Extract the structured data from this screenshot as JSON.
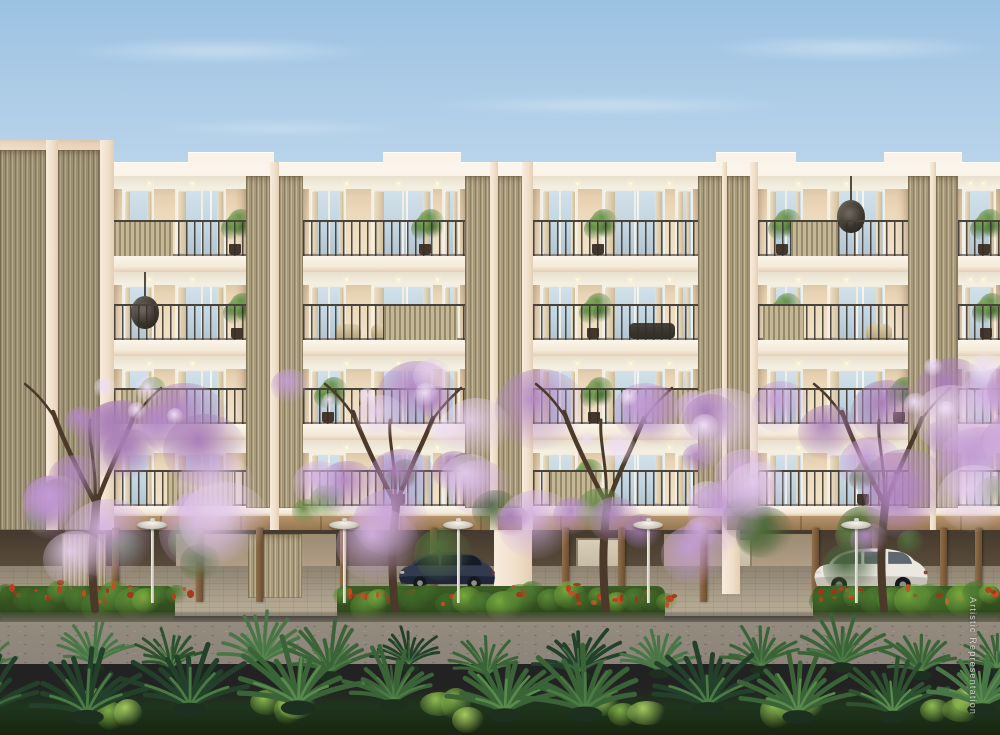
{
  "watermark": {
    "text": "Artistic Representation"
  },
  "scene": {
    "description": "Architectural rendering of a 4-storey cream apartment building with balconies, louver screens, stilt parking with two cars, purple flowering trees, garden lamps, red-flower hedges, a road and foreground palms",
    "colors": {
      "sky_top": "#9cc2e2",
      "sky_mid": "#c6dcee",
      "sky_horizon": "#edf2f2",
      "facade": "#f6e8d7",
      "facade_wing": "#f0deca",
      "roof_band": "#f9f3e9",
      "interior": "#ecd9bb",
      "ceiling": "#f4efe3",
      "glass": "#c8d9e4",
      "curtain": "#e6dac1",
      "railing": "#413c34",
      "louver_light": "#c2b594",
      "louver_dark": "#8c7f63",
      "wood_beam": "#b6946c",
      "wood_post": "#7c5c3c",
      "stilt_dark": "#443a2d",
      "stilt_mid": "#6e5f4b",
      "backwall": "#c0ae92",
      "paver_lit": "#b3a892",
      "paver_shade": "#8d8270",
      "curb": "#6e675c",
      "road": "#8d8479",
      "hedge_green": "#4c7a31",
      "hedge_light": "#76a93e",
      "flower_red": "#bb3f1e",
      "blossoms": [
        "#d5b3e2",
        "#c39cd4",
        "#b287c4",
        "#e3cdeb",
        "#a97fb8"
      ],
      "leaf_green": "#647f41",
      "trunk": "#4b392a",
      "palm_greens": [
        "#22402a",
        "#2e512f",
        "#3a6438",
        "#497647"
      ],
      "car_dark": "#323a4e",
      "car_white": "#ebe8e2",
      "lamp": "#eae7dd"
    },
    "building": {
      "roof_y": 162,
      "wing_top": 140,
      "wing_w": 114,
      "base_y": 530,
      "parapet_steps": [
        [
          188,
          86
        ],
        [
          383,
          78
        ],
        [
          716,
          80
        ],
        [
          884,
          78
        ]
      ],
      "floor_openings": [
        [
          176,
          256
        ],
        [
          272,
          340
        ],
        [
          356,
          424
        ],
        [
          440,
          506
        ]
      ],
      "rail_h": 36,
      "modules": [
        [
          "louver",
          0,
          46,
          1
        ],
        [
          "pier",
          46,
          12,
          1
        ],
        [
          "louver",
          58,
          42,
          1
        ],
        [
          "pier",
          100,
          14,
          1
        ],
        [
          "bay",
          114,
          132,
          0
        ],
        [
          "louver",
          246,
          24,
          0
        ],
        [
          "pier",
          270,
          9,
          0
        ],
        [
          "louver",
          279,
          24,
          0
        ],
        [
          "bay",
          303,
          162,
          0
        ],
        [
          "louver",
          465,
          25,
          0
        ],
        [
          "pier",
          490,
          8,
          0
        ],
        [
          "louver",
          498,
          24,
          0
        ],
        [
          "pier",
          522,
          11,
          0
        ],
        [
          "bay",
          533,
          165,
          0
        ],
        [
          "louver",
          698,
          24,
          0
        ],
        [
          "pier",
          722,
          5,
          0
        ],
        [
          "louver",
          727,
          23,
          0
        ],
        [
          "pier",
          750,
          8,
          0
        ],
        [
          "bay",
          758,
          150,
          0
        ],
        [
          "louver",
          908,
          22,
          0
        ],
        [
          "pier",
          930,
          6,
          0
        ],
        [
          "louver",
          936,
          22,
          0
        ],
        [
          "bay",
          958,
          42,
          0
        ]
      ],
      "slat_sections": [
        [
          0,
          0,
          0.0,
          0.45
        ],
        [
          0,
          3,
          0.22,
          0.53
        ],
        [
          1,
          1,
          0.5,
          0.95
        ],
        [
          1,
          3,
          0.03,
          0.3
        ],
        [
          2,
          0,
          0.05,
          0.5
        ],
        [
          2,
          2,
          0.72,
          1
        ],
        [
          3,
          2,
          0.1,
          0.4
        ],
        [
          3,
          0,
          0.4,
          0.9
        ]
      ],
      "decorations": [
        [
          0,
          0,
          "plant",
          0.8
        ],
        [
          0,
          1,
          "plant",
          0.66
        ],
        [
          0,
          2,
          "plant",
          0.3
        ],
        [
          0,
          3,
          "plant",
          0.06
        ],
        [
          0,
          3,
          "egg",
          0.52
        ],
        [
          0,
          4,
          "plant",
          0.25
        ],
        [
          1,
          0,
          "egg",
          0.12
        ],
        [
          1,
          0,
          "plant",
          0.82
        ],
        [
          1,
          1,
          "seat",
          0.2
        ],
        [
          1,
          1,
          "seat",
          0.42
        ],
        [
          1,
          2,
          "plant",
          0.27
        ],
        [
          1,
          2,
          "sofa",
          0.58
        ],
        [
          1,
          3,
          "seat",
          0.72
        ],
        [
          1,
          3,
          "plant",
          0.06
        ],
        [
          1,
          4,
          "plant",
          0.3
        ],
        [
          2,
          0,
          "plant",
          0.14
        ],
        [
          2,
          1,
          "plant",
          0.06
        ],
        [
          2,
          2,
          "plant",
          0.28
        ],
        [
          2,
          3,
          "plant",
          0.84
        ],
        [
          3,
          1,
          "plant",
          0.5
        ],
        [
          3,
          2,
          "plant",
          0.22
        ],
        [
          3,
          3,
          "plant",
          0.6
        ]
      ]
    },
    "stilt": {
      "slab": [
        506,
        516
      ],
      "beam": [
        516,
        530
      ],
      "zone": [
        530,
        612
      ],
      "floor_top": 566,
      "posts": [
        112,
        196,
        256,
        340,
        430,
        562,
        618,
        700,
        812,
        872,
        940,
        975
      ],
      "screens": [
        [
          62,
          44
        ],
        [
          248,
          54
        ]
      ],
      "ground_piers": [
        [
          494,
          38
        ],
        [
          722,
          18
        ]
      ],
      "backwalls": [
        [
          176,
          160
        ],
        [
          664,
          148
        ]
      ],
      "back_doors": [
        [
          576,
          46
        ],
        [
          726,
          26
        ]
      ]
    },
    "hedge": {
      "band": [
        578,
        622
      ],
      "segments": [
        [
          0,
          175
        ],
        [
          337,
          328
        ],
        [
          813,
          187
        ]
      ]
    },
    "ground": {
      "curb": [
        612,
        622
      ],
      "road": [
        622,
        664
      ],
      "palm_base": [
        688,
        735
      ]
    },
    "cars": [
      {
        "name": "hatchback-dark",
        "color": "#323a4e",
        "shade": "#20263a",
        "window": "#161b28",
        "x": 396,
        "y": 544,
        "w": 102,
        "h": 48
      },
      {
        "name": "hatchback-white",
        "color": "#ebe8e2",
        "shade": "#c7c2b8",
        "window": "#5f686e",
        "x": 810,
        "y": 540,
        "w": 122,
        "h": 54
      }
    ],
    "lamps": {
      "xs": [
        152,
        344,
        458,
        648,
        856
      ],
      "disc_y": 521,
      "base_y": 603,
      "disc_w": 30
    },
    "trees": [
      {
        "trunk_x": 95,
        "x": -15,
        "w": 252,
        "top": 372,
        "bottom": 566
      },
      {
        "trunk_x": 395,
        "x": 242,
        "w": 282,
        "top": 356,
        "bottom": 568
      },
      {
        "trunk_x": 606,
        "x": 528,
        "w": 246,
        "top": 376,
        "bottom": 566
      },
      {
        "trunk_x": 884,
        "x": 786,
        "w": 230,
        "top": 350,
        "bottom": 570
      }
    ],
    "palms": {
      "rows": [
        {
          "y": 668,
          "scale": 0.8,
          "count": 13
        },
        {
          "y": 708,
          "scale": 1.12,
          "count": 11
        }
      ]
    },
    "shrub_clumps": [
      90,
      260,
      430,
      600,
      770,
      930
    ]
  }
}
